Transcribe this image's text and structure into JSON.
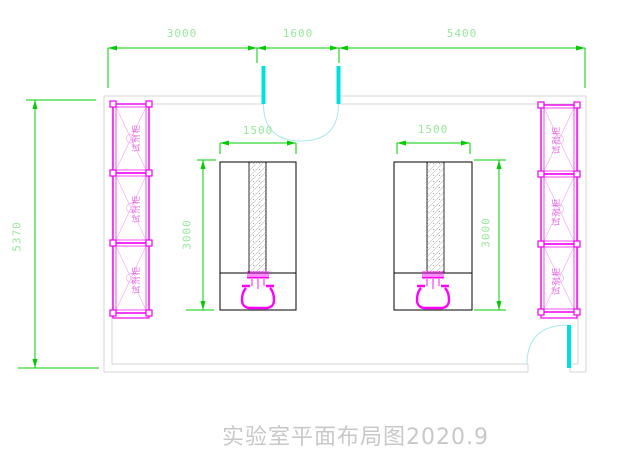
{
  "drawing": {
    "title": "实验室平面布局图2020.9",
    "dimensions": {
      "top": [
        "3000",
        "1600",
        "5400"
      ],
      "left_overall": "5370",
      "bench_left": {
        "width": "1500",
        "depth": "3000"
      },
      "bench_right": {
        "width": "1500",
        "depth": "3000"
      }
    },
    "cabinets": {
      "label": "试剂柜",
      "left_count": 3,
      "right_count": 3
    },
    "colors": {
      "dimension_line": "#00cc00",
      "dimension_text": "#96e89a",
      "cabinet": "#f000f0",
      "fixture": "#ff00ff",
      "door_leaf": "#00e0e0",
      "door_arc": "#a8e8ec",
      "wall": "#d5d5d5",
      "bench_outline": "#000000",
      "title_text": "#c8c8c8"
    }
  }
}
